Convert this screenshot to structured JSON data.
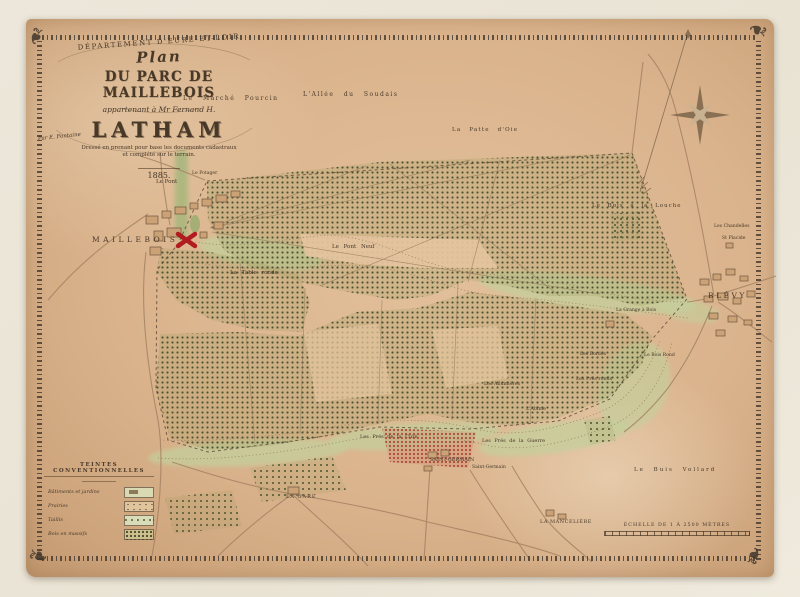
{
  "title_block": {
    "department": "DÉPARTEMENT D'EURE-ET-LOIR",
    "plan": "Plan",
    "title": "DU PARC DE MAILLEBOIS",
    "subtitle": "appartenant à Mr Fernand H.",
    "owner": "LATHAM",
    "note1": "Dressé en prenant pour base les documents cadastraux",
    "note2": "et complété sur le terrain.",
    "surveyor": "Par E. Fontaine",
    "year": "1885."
  },
  "legend": {
    "title": "TEINTES CONVENTIONNELLES",
    "items": [
      {
        "label": "Bâtiments et jardins"
      },
      {
        "label": "Prairies"
      },
      {
        "label": "Taillis"
      },
      {
        "label": "Bois en massifs"
      }
    ]
  },
  "scale_bar": {
    "label": "ÉCHELLE DE 1 À 2500 MÈTRES"
  },
  "icons": {
    "corner_flourish": "❧"
  },
  "colors": {
    "paper": "#dab38c",
    "mat": "#ece7da",
    "ink": "#473828",
    "woods_dot": "#4d5233",
    "meadow": "#c4cf9c",
    "chateau_red": "#b01c20"
  },
  "map": {
    "labels": [
      {
        "text": "MAILLEBOIS"
      },
      {
        "text": "BLÉVY"
      },
      {
        "text": "Le Marché Pourcin"
      },
      {
        "text": "L'Allée du Soudais"
      },
      {
        "text": "La Patte d'Oie"
      },
      {
        "text": "Le Bois à la Louche"
      },
      {
        "text": "Les Chandelles"
      },
      {
        "text": "St Placide"
      },
      {
        "text": "Le Pont"
      },
      {
        "text": "Le Potager"
      },
      {
        "text": "Le Pont Neuf"
      },
      {
        "text": "La Table ronde"
      },
      {
        "text": "La Grange à Bois"
      },
      {
        "text": "Les Bordes"
      },
      {
        "text": "Le Bois Rond"
      },
      {
        "text": "Les Prés ronds"
      },
      {
        "text": "Les Allumières"
      },
      {
        "text": "L'Abîme"
      },
      {
        "text": "Les Prés de la Cure"
      },
      {
        "text": "Les Prés de la Guerre"
      },
      {
        "text": "SAINT-GERMAIN"
      },
      {
        "text": "Saint-Germain"
      },
      {
        "text": "Le Buis Vollard"
      },
      {
        "text": "LA GARE"
      },
      {
        "text": "LA MANCELIÈRE"
      }
    ]
  }
}
